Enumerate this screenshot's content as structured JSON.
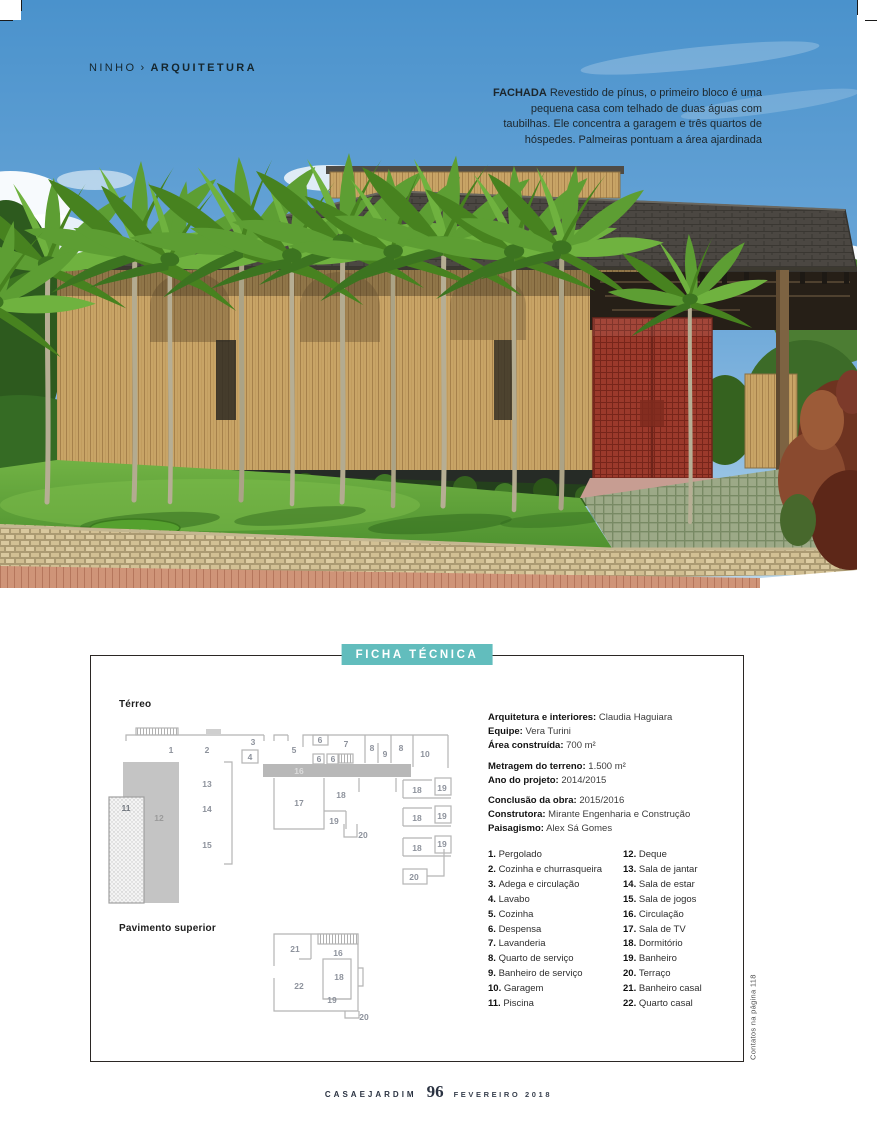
{
  "accent_color": "#62bdbd",
  "header": {
    "section": "NINHO",
    "separator": "›",
    "category": "ARQUITETURA"
  },
  "photo": {
    "caption_title": "FACHADA",
    "caption_body": " Revestido de pínus, o primeiro bloco é uma pequena casa com telhado de duas águas com taubilhas. Ele concentra a garagem e três quartos de hóspedes. Palmeiras pontuam a área ajardinada",
    "scene": "casa de madeira com telhado de taubilhas, portão vermelho, palmeiras e gramado"
  },
  "ficha": {
    "title": "FICHA TÉCNICA",
    "plans": {
      "terreo_label": "Térreo",
      "superior_label": "Pavimento superior"
    },
    "spec_groups": [
      [
        {
          "label": "Arquitetura e interiores:",
          "value": " Claudia Haguiara"
        },
        {
          "label": "Equipe:",
          "value": " Vera Turini"
        },
        {
          "label": "Área construída:",
          "value": " 700 m²"
        }
      ],
      [
        {
          "label": "Metragem do terreno:",
          "value": " 1.500 m²"
        },
        {
          "label": "Ano do projeto:",
          "value": " 2014/2015"
        }
      ],
      [
        {
          "label": "Conclusão da obra:",
          "value": " 2015/2016"
        },
        {
          "label": "Construtora:",
          "value": " Mirante Engenharia e Construção"
        },
        {
          "label": "Paisagismo:",
          "value": " Alex Sá Gomes"
        }
      ]
    ],
    "legend_left": [
      {
        "num": "1.",
        "name": "Pergolado"
      },
      {
        "num": "2.",
        "name": "Cozinha e churrasqueira"
      },
      {
        "num": "3.",
        "name": "Adega e circulação"
      },
      {
        "num": "4.",
        "name": "Lavabo"
      },
      {
        "num": "5.",
        "name": "Cozinha"
      },
      {
        "num": "6.",
        "name": "Despensa"
      },
      {
        "num": "7.",
        "name": "Lavanderia"
      },
      {
        "num": "8.",
        "name": "Quarto de serviço"
      },
      {
        "num": "9.",
        "name": "Banheiro de serviço"
      },
      {
        "num": "10.",
        "name": "Garagem"
      },
      {
        "num": "11.",
        "name": "Piscina"
      }
    ],
    "legend_right": [
      {
        "num": "12.",
        "name": "Deque"
      },
      {
        "num": "13.",
        "name": "Sala de jantar"
      },
      {
        "num": "14.",
        "name": "Sala de estar"
      },
      {
        "num": "15.",
        "name": "Sala de jogos"
      },
      {
        "num": "16.",
        "name": "Circulação"
      },
      {
        "num": "17.",
        "name": "Sala de TV"
      },
      {
        "num": "18.",
        "name": "Dormitório"
      },
      {
        "num": "19.",
        "name": "Banheiro"
      },
      {
        "num": "20.",
        "name": "Terraço"
      },
      {
        "num": "21.",
        "name": "Banheiro casal"
      },
      {
        "num": "22.",
        "name": "Quarto casal"
      }
    ],
    "plan_labels_terreo": [
      {
        "t": "1",
        "x": 70,
        "y": 62
      },
      {
        "t": "2",
        "x": 106,
        "y": 62
      },
      {
        "t": "3",
        "x": 152,
        "y": 54
      },
      {
        "t": "4",
        "x": 149,
        "y": 69
      },
      {
        "t": "5",
        "x": 193,
        "y": 62
      },
      {
        "t": "6",
        "x": 219,
        "y": 52
      },
      {
        "t": "7",
        "x": 245,
        "y": 56
      },
      {
        "t": "8",
        "x": 271,
        "y": 60
      },
      {
        "t": "9",
        "x": 284,
        "y": 66
      },
      {
        "t": "8",
        "x": 300,
        "y": 60
      },
      {
        "t": "10",
        "x": 324,
        "y": 66
      },
      {
        "t": "6",
        "x": 218,
        "y": 71
      },
      {
        "t": "6",
        "x": 232,
        "y": 71
      },
      {
        "t": "16",
        "x": 198,
        "y": 83,
        "c": "light"
      },
      {
        "t": "13",
        "x": 106,
        "y": 96
      },
      {
        "t": "14",
        "x": 106,
        "y": 121
      },
      {
        "t": "15",
        "x": 106,
        "y": 157
      },
      {
        "t": "12",
        "x": 58,
        "y": 130,
        "c": "mid"
      },
      {
        "t": "11",
        "x": 25,
        "y": 120,
        "c": "dark"
      },
      {
        "t": "17",
        "x": 198,
        "y": 115
      },
      {
        "t": "18",
        "x": 240,
        "y": 107
      },
      {
        "t": "19",
        "x": 233,
        "y": 133
      },
      {
        "t": "20",
        "x": 262,
        "y": 147
      },
      {
        "t": "18",
        "x": 316,
        "y": 102
      },
      {
        "t": "19",
        "x": 341,
        "y": 100
      },
      {
        "t": "18",
        "x": 316,
        "y": 130
      },
      {
        "t": "19",
        "x": 341,
        "y": 128
      },
      {
        "t": "18",
        "x": 316,
        "y": 160
      },
      {
        "t": "19",
        "x": 341,
        "y": 156
      },
      {
        "t": "20",
        "x": 313,
        "y": 189
      }
    ],
    "plan_labels_superior": [
      {
        "t": "21",
        "x": 194,
        "y": 46
      },
      {
        "t": "16",
        "x": 237,
        "y": 50
      },
      {
        "t": "18",
        "x": 238,
        "y": 74
      },
      {
        "t": "22",
        "x": 198,
        "y": 83
      },
      {
        "t": "19",
        "x": 231,
        "y": 97
      },
      {
        "t": "20",
        "x": 263,
        "y": 114
      }
    ],
    "contact_note": "Contatos na página 118"
  },
  "footer": {
    "magazine": "CASAEJARDIM",
    "page_number": "96",
    "issue": "FEVEREIRO 2018"
  }
}
